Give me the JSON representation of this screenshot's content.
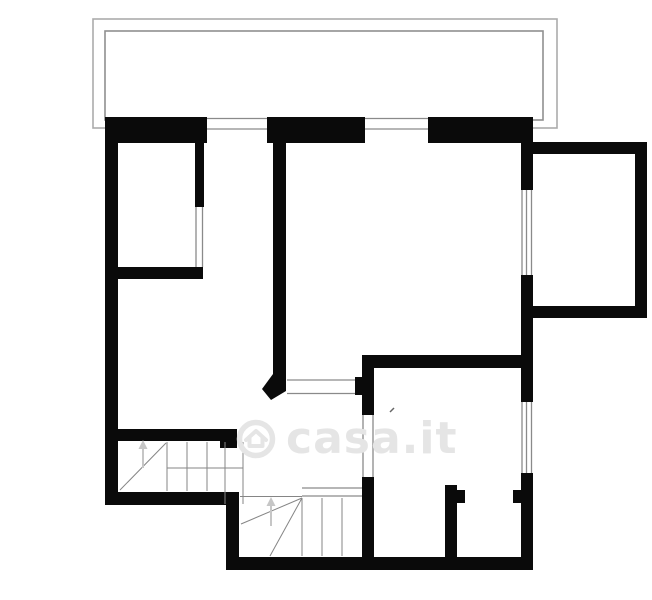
{
  "page": {
    "title": "Planimetria"
  },
  "canvas": {
    "width": 652,
    "height": 600,
    "background": "#ffffff"
  },
  "colors": {
    "wall": "#0a0a0a",
    "balcony_outer": "#ababab",
    "balcony_inner": "#8f8f8f",
    "window_line": "#8a8a8a",
    "stair_line": "#858585",
    "arrow": "#c6c6c6",
    "watermark": "#e5e5e5",
    "mark": "#666666"
  },
  "balcony": {
    "outer": [
      93,
      19,
      464,
      109
    ],
    "inner": [
      105,
      31,
      438,
      89
    ]
  },
  "walls": [
    {
      "name": "top-wall-left-segment",
      "r": [
        105,
        117,
        102,
        26
      ]
    },
    {
      "name": "top-wall-middle-segment",
      "r": [
        267,
        117,
        98,
        26
      ]
    },
    {
      "name": "top-wall-right-segment",
      "r": [
        428,
        117,
        105,
        26
      ]
    },
    {
      "name": "left-exterior-wall",
      "r": [
        105,
        117,
        13,
        388
      ]
    },
    {
      "name": "bedroom-right-wall",
      "r": [
        195,
        143,
        9,
        64
      ]
    },
    {
      "name": "bedroom-bottom-wall",
      "r": [
        105,
        267,
        98,
        12
      ]
    },
    {
      "name": "central-partition-wall",
      "r": [
        273,
        143,
        13,
        240
      ]
    },
    {
      "name": "right-exterior-wall-upper",
      "r": [
        521,
        117,
        12,
        73
      ]
    },
    {
      "name": "right-exterior-wall-middle",
      "r": [
        521,
        275,
        12,
        127
      ]
    },
    {
      "name": "right-exterior-wall-lower",
      "r": [
        521,
        473,
        12,
        97
      ]
    },
    {
      "name": "side-balcony-top-wall",
      "r": [
        533,
        142,
        114,
        12
      ]
    },
    {
      "name": "side-balcony-right-wall",
      "r": [
        635,
        142,
        12,
        176
      ]
    },
    {
      "name": "side-balcony-bottom-wall",
      "r": [
        533,
        306,
        114,
        12
      ]
    },
    {
      "name": "lower-room-top-wall",
      "r": [
        362,
        355,
        171,
        13
      ]
    },
    {
      "name": "lower-room-left-wall-upper",
      "r": [
        362,
        355,
        12,
        60
      ]
    },
    {
      "name": "lower-room-left-wall-lower",
      "r": [
        362,
        477,
        12,
        93
      ]
    },
    {
      "name": "closet-partition-wall",
      "r": [
        445,
        485,
        12,
        85
      ]
    },
    {
      "name": "closet-door-stub-left",
      "r": [
        457,
        490,
        8,
        13
      ]
    },
    {
      "name": "closet-door-stub-right",
      "r": [
        513,
        490,
        8,
        13
      ]
    },
    {
      "name": "stair-top-wall",
      "r": [
        118,
        429,
        112,
        12
      ]
    },
    {
      "name": "stair-top-wall-end-cap",
      "r": [
        220,
        429,
        17,
        19
      ]
    },
    {
      "name": "lower-left-bottom-wall",
      "r": [
        105,
        492,
        132,
        13
      ]
    },
    {
      "name": "stair-step-wall",
      "r": [
        226,
        492,
        13,
        78
      ]
    },
    {
      "name": "bottom-exterior-wall",
      "r": [
        226,
        557,
        307,
        13
      ]
    },
    {
      "name": "hall-opening-stub",
      "r": [
        355,
        377,
        7,
        18
      ]
    }
  ],
  "wall_polygons": [
    {
      "name": "central-wall-angled-foot",
      "points": "273,374 286,374 286,391 271,400 262,389"
    }
  ],
  "windows": [
    {
      "name": "terrace-window-left",
      "r": [
        207,
        117,
        60,
        26
      ],
      "lines": [
        [
          207,
          118.5,
          267,
          118.5
        ],
        [
          207,
          129,
          267,
          129
        ]
      ]
    },
    {
      "name": "terrace-window-right",
      "r": [
        365,
        117,
        63,
        26
      ],
      "lines": [
        [
          365,
          118.5,
          428,
          118.5
        ],
        [
          365,
          129,
          428,
          129
        ]
      ]
    },
    {
      "name": "side-balcony-window",
      "r": [
        521,
        190,
        12,
        85
      ],
      "lines": [
        [
          522,
          190,
          522,
          275
        ],
        [
          526.5,
          190,
          526.5,
          275
        ],
        [
          531.5,
          190,
          531.5,
          275
        ]
      ]
    },
    {
      "name": "lower-right-window",
      "r": [
        521,
        402,
        12,
        71
      ],
      "lines": [
        [
          522,
          402,
          522,
          473
        ],
        [
          526.5,
          402,
          526.5,
          473
        ],
        [
          531.5,
          402,
          531.5,
          473
        ]
      ]
    },
    {
      "name": "lower-room-left-window",
      "r": [
        362,
        415,
        12,
        62
      ],
      "lines": [
        [
          363,
          415,
          363,
          477
        ],
        [
          373,
          415,
          373,
          477
        ]
      ]
    },
    {
      "name": "hall-glass-opening",
      "r": [
        287,
        379,
        68,
        16
      ],
      "lines": [
        [
          287,
          380,
          355,
          380
        ],
        [
          287,
          393.5,
          355,
          393.5
        ]
      ]
    },
    {
      "name": "bedroom-door-opening",
      "r": [
        195,
        207,
        9,
        60
      ],
      "lines": [
        [
          196,
          207,
          196,
          267
        ],
        [
          202.5,
          207,
          202.5,
          267
        ]
      ]
    },
    {
      "name": "stair-landing-opening",
      "r": [
        302,
        487,
        60,
        10
      ],
      "lines": [
        [
          302,
          488,
          362,
          488
        ],
        [
          302,
          496,
          362,
          496
        ]
      ]
    }
  ],
  "stairs": {
    "flight_upper": {
      "name": "staircase-upper",
      "lines": [
        [
          167,
          442,
          167,
          491
        ],
        [
          187,
          442,
          187,
          491
        ],
        [
          207,
          442,
          207,
          491
        ],
        [
          225,
          442,
          225,
          504
        ],
        [
          243,
          442,
          243,
          504
        ],
        [
          167,
          468,
          243,
          468
        ],
        [
          120,
          490,
          166,
          443
        ]
      ],
      "arrow": {
        "x": 143,
        "from_y": 468,
        "to_y": 448
      }
    },
    "flight_lower": {
      "name": "staircase-lower",
      "lines": [
        [
          240,
          496.5,
          302,
          496.5
        ],
        [
          302,
          498,
          302,
          556
        ],
        [
          322,
          498,
          322,
          556
        ],
        [
          342,
          498,
          342,
          556
        ],
        [
          302,
          498,
          241,
          524
        ],
        [
          302,
          498,
          270,
          556
        ]
      ],
      "arrow": {
        "x": 271,
        "from_y": 526,
        "to_y": 505
      }
    }
  },
  "marks": [
    [
      390,
      412,
      394,
      408
    ]
  ],
  "watermark": {
    "text": "casa.it",
    "logo": "house-in-circle-icon",
    "cx": 257,
    "cy": 439,
    "radius": 17,
    "font_size": 44,
    "box": 44
  }
}
